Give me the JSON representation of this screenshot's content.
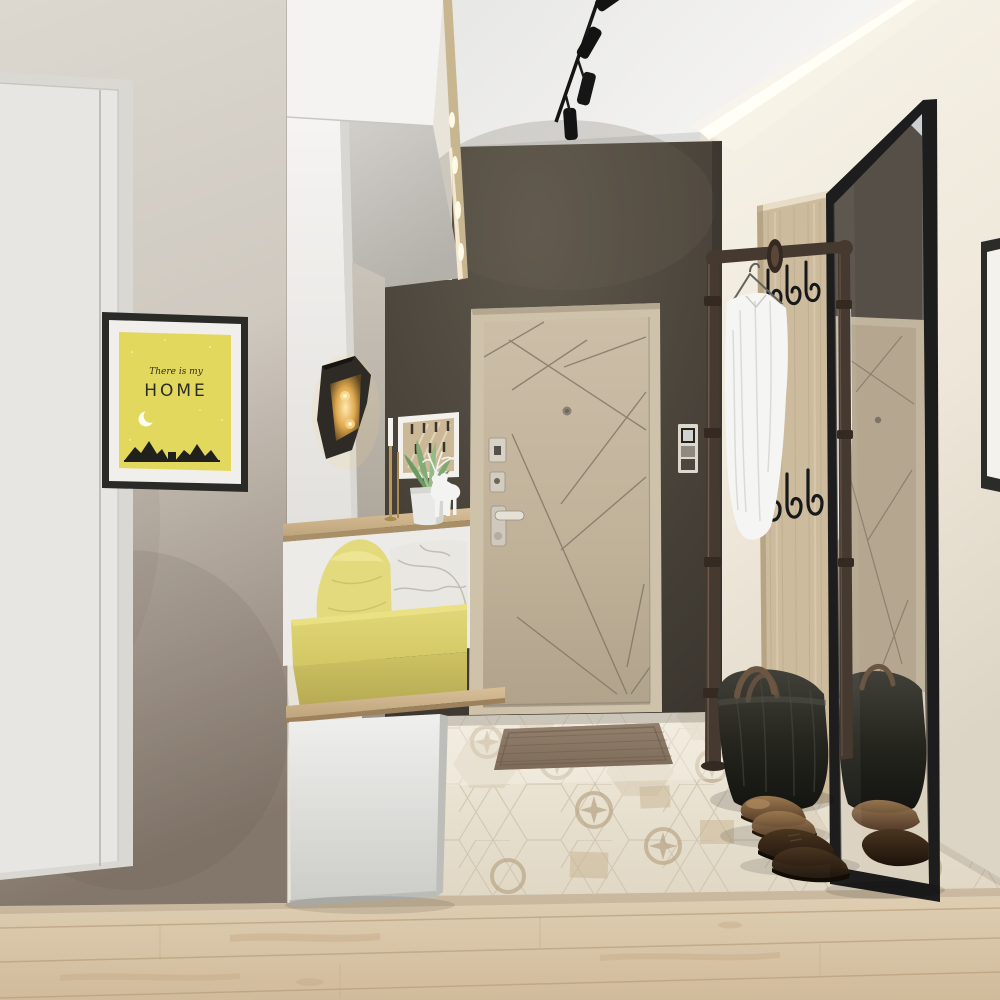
{
  "scene": {
    "type": "3d-interior-render",
    "room": "entryway-hallway",
    "style": "modern scandinavian with yellow accents"
  },
  "poster": {
    "script_line": "There is my",
    "title": "HOME"
  },
  "colors": {
    "ceiling": "#f0efed",
    "right-wall": "#f2eee4",
    "left-wall": "#d9d5cd",
    "left-wall-dark": "#87796d",
    "accent-wall": "#4b443b",
    "door": "#c3b49c",
    "door-frame": "#cec2ab",
    "door-line": "#837967",
    "poster-frame": "#2a2a27",
    "poster-yellow": "#e2d85e",
    "poster-ink": "#2c2c26",
    "cushion": "#ddd36e",
    "pillow-yellow": "#e3da7e",
    "pillow-marble": "#e9e7e2",
    "wood": "#ccb795",
    "wood-floor": "#d8c5a9",
    "tile": "#ebe4d5",
    "tile-ornament": "#b6a384",
    "mat": "#8a7665",
    "pipe": "#46392f",
    "pipe-dark": "#352a22",
    "hook": "#17181a",
    "mirror-frame": "#1d1d1d",
    "shirt": "#f5f5f3",
    "bag": "#23231e",
    "bag-handle": "#6b5642",
    "shoe-bronze": "#8d6b47",
    "shoe-dark": "#322316",
    "sconce": "#2e2a25",
    "sconce-glow": "#f7d98f",
    "deer": "#f3f3f1",
    "pot": "#e9e9e7",
    "plant": "#84ab76",
    "intercom": "#ddd8cb",
    "cove-glow": "#fffef8",
    "cabinet": "#f2f1ee",
    "base-cabinet": "#e3e3e0"
  },
  "objects": [
    "track-lighting",
    "cove-light",
    "entrance-door",
    "peephole",
    "door-locks",
    "door-handle",
    "intercom-panel",
    "home-poster",
    "interior-door",
    "upper-cabinets",
    "led-strip",
    "wall-sconce",
    "leaf-art",
    "candlestick",
    "potted-succulent",
    "deer-figurine",
    "bench",
    "seat-cushion",
    "yellow-pillow",
    "marble-pillow",
    "base-cabinet",
    "pipe-coat-rack",
    "clothes-hanger",
    "white-shirt",
    "hook-panel",
    "coat-hooks",
    "leaning-mirror",
    "duffel-bag",
    "leather-shoes",
    "doormat",
    "patterned-tile-floor",
    "wood-plank-floor",
    "picture-frame-edge"
  ]
}
